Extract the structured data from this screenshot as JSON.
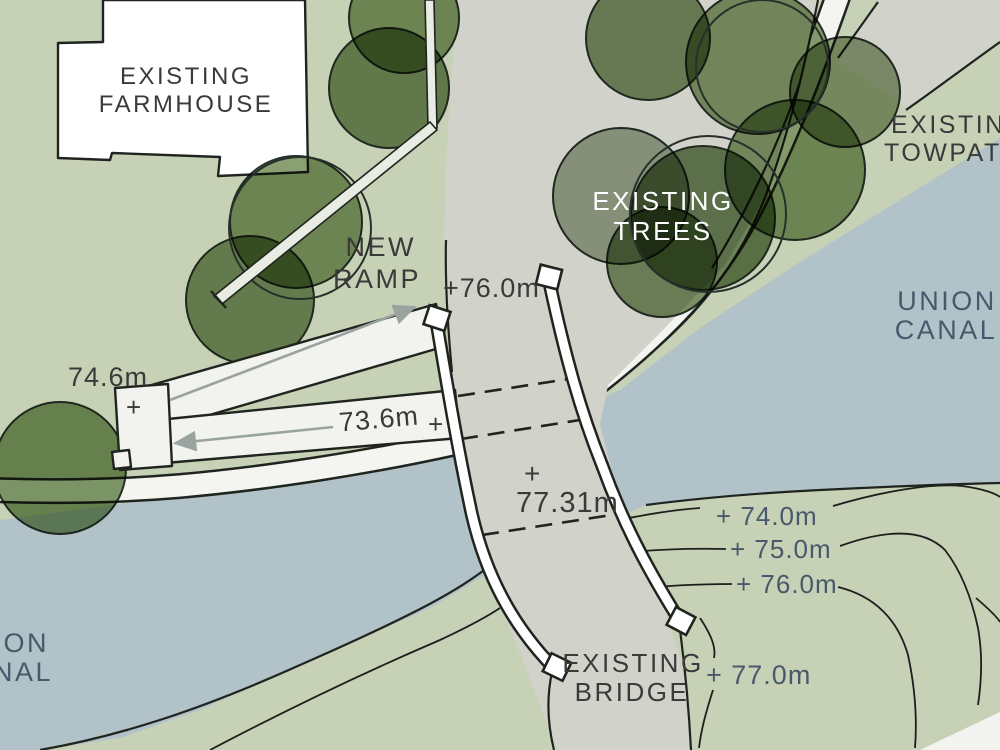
{
  "title": "Canal bridge landscape site plan sketch",
  "labels": {
    "farmhouse": {
      "line1": "EXISTING",
      "line2": "FARMHOUSE"
    },
    "new_ramp": {
      "line1": "NEW",
      "line2": "RAMP"
    },
    "existing_trees": {
      "line1": "EXISTING",
      "line2": "TREES"
    },
    "existing_towpath": {
      "line1": "EXISTING",
      "line2": "TOWPATH"
    },
    "union_canal_east": {
      "line1": "UNION",
      "line2": "CANAL"
    },
    "union_canal_west": {
      "line1": "UNION",
      "line2": "CANAL"
    },
    "existing_bridge": {
      "line1": "EXISTING",
      "line2": "BRIDGE"
    }
  },
  "elevations": {
    "deck_north": "+76.0m",
    "upper_landing": "74.6m",
    "lower_ramp": "73.6m",
    "bridge_centre": "77.31m",
    "plus_mark": "+",
    "contour_74": "+ 74.0m",
    "contour_75": "+ 75.0m",
    "contour_76": "+ 76.0m",
    "contour_77": "+ 77.0m"
  },
  "colors": {
    "grass": "#c7d1b6",
    "water": "#b2c2c9",
    "track": "#d1d2ca",
    "paper_white": "#f4f4f0",
    "ink": "#20241f",
    "arrow_grey": "#9aa3a0",
    "tree_mid": "#7d9663",
    "tree_dark": "#6e8757",
    "tree_deep": "#5f7a4c",
    "tree_grey": "#9aa58c",
    "tree_olive": "#8a9b74",
    "text_dark": "#3a3a3a",
    "text_slate": "#48596b",
    "text_white": "#ffffff"
  }
}
